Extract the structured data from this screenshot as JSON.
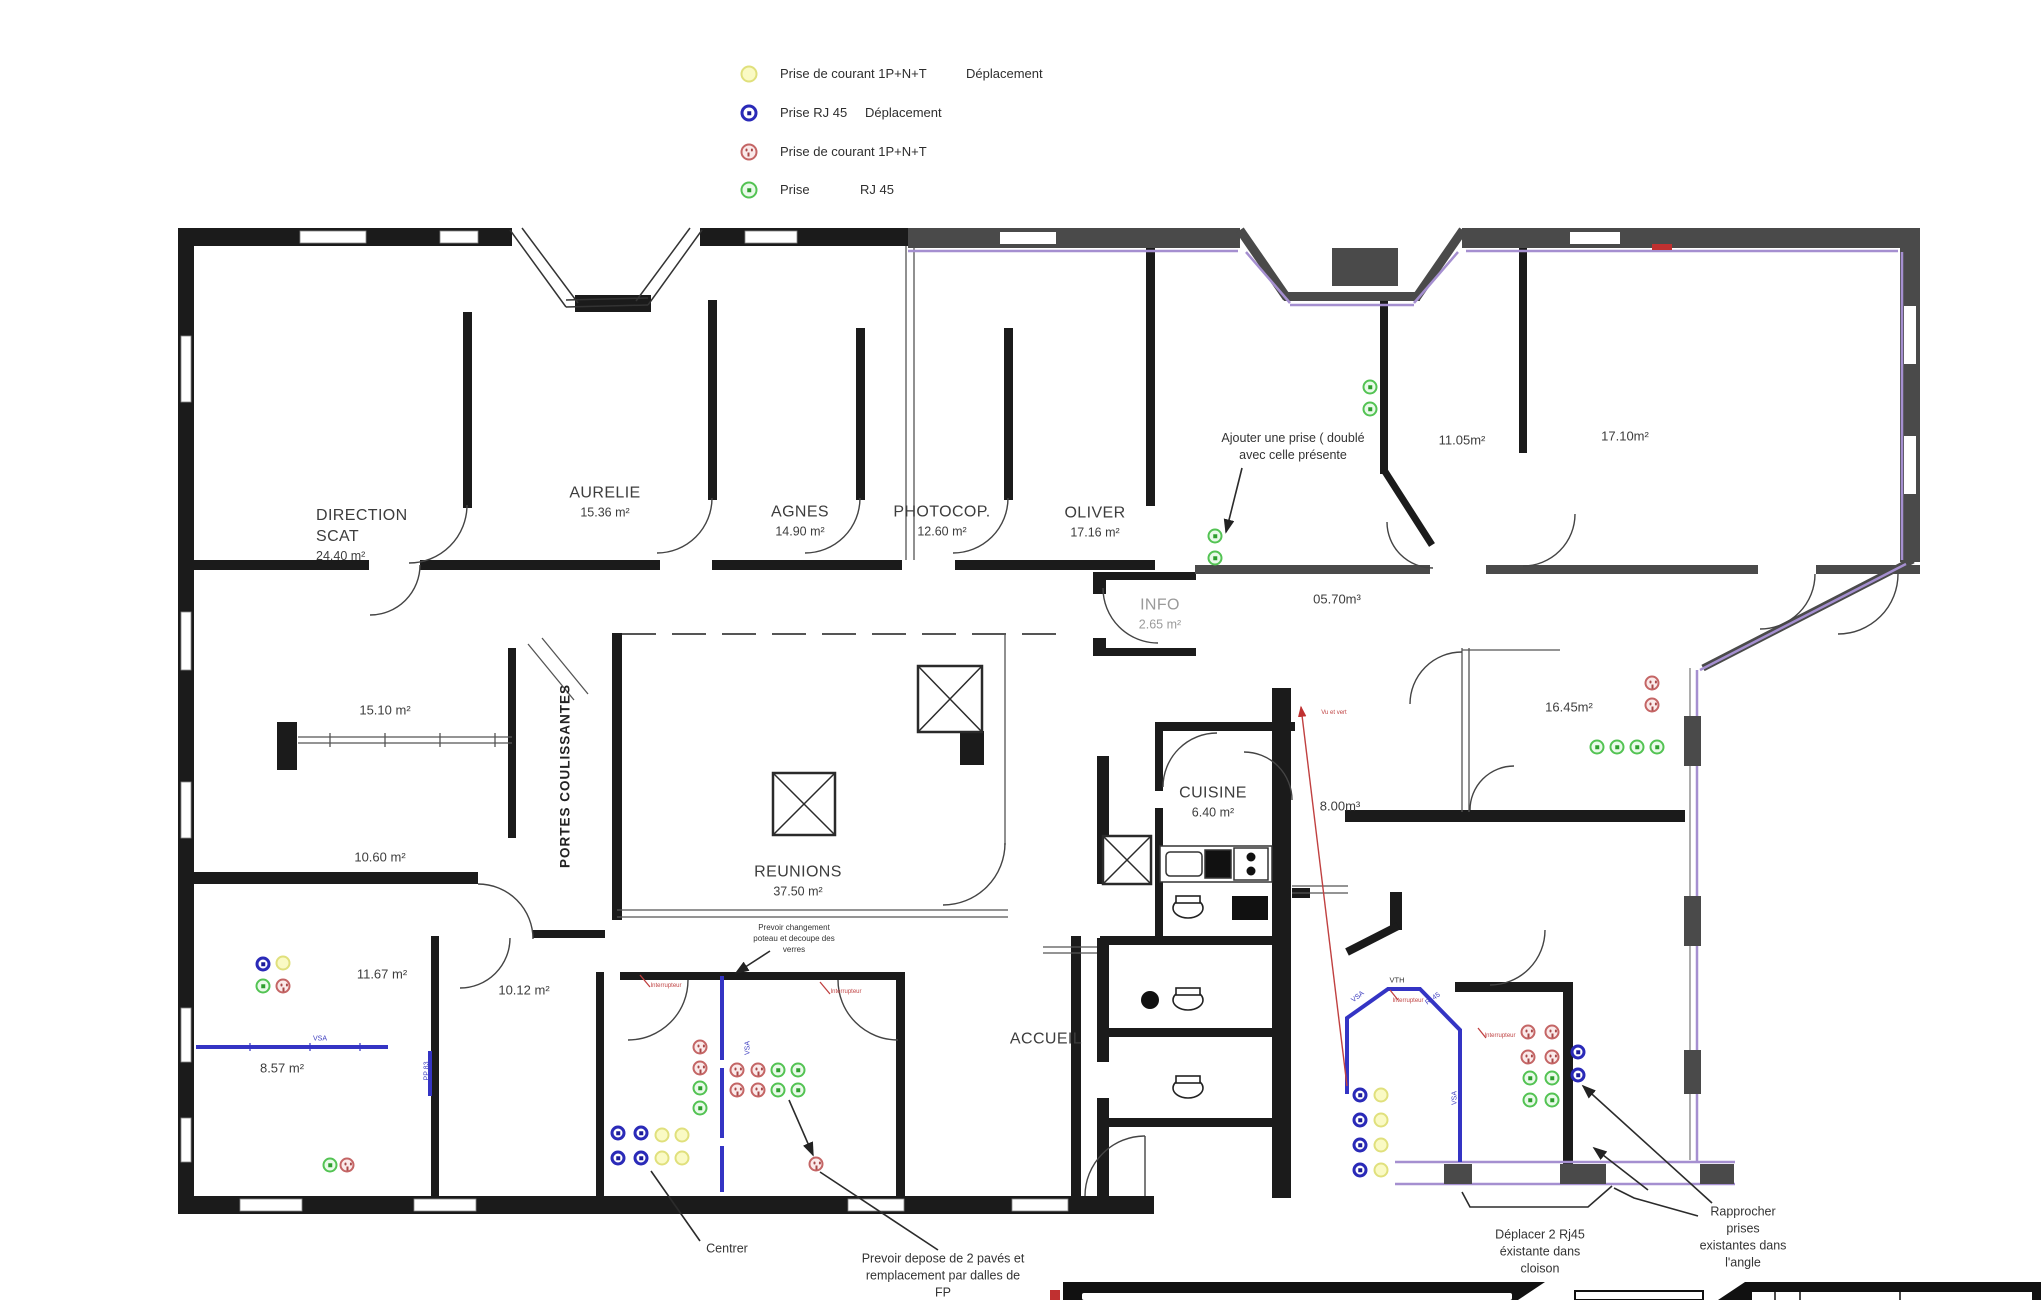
{
  "legend": {
    "rows": [
      {
        "icon": "prise-courant-deplacement",
        "type": "py",
        "label": "Prise de courant 1P+N+T",
        "extra": "Déplacement",
        "icon_x": 749,
        "y": 74,
        "extra_x": 966
      },
      {
        "icon": "prise-rj45-deplacement",
        "type": "rb",
        "label": "Prise RJ 45",
        "extra": "Déplacement",
        "icon_x": 749,
        "y": 113,
        "extra_x": 865
      },
      {
        "icon": "prise-courant",
        "type": "pr",
        "label": "Prise de courant 1P+N+T",
        "extra": "",
        "icon_x": 749,
        "y": 152,
        "extra_x": 0
      },
      {
        "icon": "prise-rj45",
        "type": "rg",
        "label": "Prise",
        "extra": "RJ 45",
        "icon_x": 749,
        "y": 190,
        "extra_x": 860
      }
    ]
  },
  "socket_types": {
    "py": "Prise de courant 1P+N+T Déplacement",
    "rb": "Prise RJ 45 Déplacement",
    "pr": "Prise de courant 1P+N+T",
    "rg": "Prise RJ 45"
  },
  "rooms": [
    {
      "name_lines": [
        "DIRECTION",
        "SCAT"
      ],
      "area": "24.40 m²",
      "x": 316,
      "y": 535,
      "align": "left"
    },
    {
      "name_lines": [
        "AURELIE"
      ],
      "area": "15.36 m²",
      "x": 605,
      "y": 502
    },
    {
      "name_lines": [
        "AGNES"
      ],
      "area": "14.90 m²",
      "x": 800,
      "y": 521
    },
    {
      "name_lines": [
        "PHOTOCOP."
      ],
      "area": "12.60 m²",
      "x": 942,
      "y": 521
    },
    {
      "name_lines": [
        "OLIVER"
      ],
      "area": "17.16 m²",
      "x": 1095,
      "y": 522
    },
    {
      "name_lines": [
        "INFO"
      ],
      "area": "2.65 m²",
      "x": 1160,
      "y": 614,
      "color": "#9a9a9a"
    },
    {
      "name_lines": [
        "REUNIONS"
      ],
      "area": "37.50 m²",
      "x": 798,
      "y": 881
    },
    {
      "name_lines": [
        "CUISINE"
      ],
      "area": "6.40 m²",
      "x": 1213,
      "y": 802
    },
    {
      "name_lines": [
        "ACCUEIL"
      ],
      "area": "",
      "x": 1046,
      "y": 1040
    },
    {
      "name_lines": [],
      "area": "15.10 m²",
      "x": 385,
      "y": 711
    },
    {
      "name_lines": [],
      "area": "10.60 m²",
      "x": 380,
      "y": 858
    },
    {
      "name_lines": [],
      "area": "11.67 m²",
      "x": 382,
      "y": 975
    },
    {
      "name_lines": [],
      "area": "10.12 m²",
      "x": 524,
      "y": 991
    },
    {
      "name_lines": [],
      "area": "8.57 m²",
      "x": 282,
      "y": 1069
    },
    {
      "name_lines": [],
      "area": "05.70m³",
      "x": 1337,
      "y": 600
    },
    {
      "name_lines": [],
      "area": "11.05m²",
      "x": 1462,
      "y": 441
    },
    {
      "name_lines": [],
      "area": "17.10m²",
      "x": 1625,
      "y": 437
    },
    {
      "name_lines": [],
      "area": "16.45m²",
      "x": 1569,
      "y": 708
    },
    {
      "name_lines": [],
      "area": "8.00m³",
      "x": 1340,
      "y": 807
    }
  ],
  "annotations": [
    {
      "id": "ajouter-prise",
      "lines": [
        "Ajouter une prise ( doublé",
        "avec celle présente"
      ],
      "x": 1293,
      "y": 447,
      "size": 12.5
    },
    {
      "id": "prevoir-changement",
      "lines": [
        "Prevoir changement",
        "poteau et decoupe des",
        "verres"
      ],
      "x": 794,
      "y": 939,
      "size": 8
    },
    {
      "id": "centrer",
      "lines": [
        "Centrer"
      ],
      "x": 727,
      "y": 1249,
      "size": 12.5
    },
    {
      "id": "prevoir-depose",
      "lines": [
        "Prevoir depose de 2 pavés et",
        "remplacement par dalles de",
        "FP"
      ],
      "x": 943,
      "y": 1276,
      "size": 12.5
    },
    {
      "id": "deplacer-rj45",
      "lines": [
        "Déplacer 2 Rj45",
        "éxistante dans",
        "cloison"
      ],
      "x": 1540,
      "y": 1252,
      "size": 12.5
    },
    {
      "id": "rapprocher-prises",
      "lines": [
        "Rapprocher",
        "prises",
        "existantes dans",
        "l'angle"
      ],
      "x": 1743,
      "y": 1237,
      "size": 12.5
    }
  ],
  "wall_labels": [
    {
      "text": "PORTES COULISSANTES",
      "x": 565,
      "y": 776,
      "rot": -90,
      "size": 13.5,
      "color": "#222",
      "bold": true,
      "spacing": 1
    },
    {
      "text": "VSA",
      "x": 320,
      "y": 1039,
      "rot": 0,
      "size": 7,
      "color": "#4040c0"
    },
    {
      "text": "VSA",
      "x": 748,
      "y": 1048,
      "rot": -90,
      "size": 7,
      "color": "#4040c0"
    },
    {
      "text": "VSA",
      "x": 1358,
      "y": 997,
      "rot": -38,
      "size": 7,
      "color": "#4040c0"
    },
    {
      "text": "VSA",
      "x": 1455,
      "y": 1098,
      "rot": -90,
      "size": 7,
      "color": "#4040c0"
    },
    {
      "text": "Rj 45",
      "x": 1433,
      "y": 999,
      "rot": -35,
      "size": 7,
      "color": "#4040c0"
    },
    {
      "text": "VTH",
      "x": 1397,
      "y": 980,
      "rot": 0,
      "size": 7.5,
      "color": "#333"
    },
    {
      "text": "PP 83",
      "x": 427,
      "y": 1071,
      "rot": -90,
      "size": 7,
      "color": "#4040c0"
    },
    {
      "text": "Interrupteur",
      "x": 666,
      "y": 986,
      "rot": 0,
      "size": 6,
      "color": "#c04545"
    },
    {
      "text": "Interrupteur",
      "x": 846,
      "y": 992,
      "rot": 0,
      "size": 6,
      "color": "#c04545"
    },
    {
      "text": "Interrupteur",
      "x": 1408,
      "y": 1001,
      "rot": 0,
      "size": 6,
      "color": "#c04545"
    },
    {
      "text": "Interrupteur",
      "x": 1500,
      "y": 1036,
      "rot": 0,
      "size": 6,
      "color": "#c04545"
    },
    {
      "text": "Vu et vert",
      "x": 1334,
      "y": 713,
      "rot": 0,
      "size": 6,
      "color": "#c04545"
    }
  ],
  "sockets": [
    {
      "t": "rg",
      "x": 1370,
      "y": 387
    },
    {
      "t": "rg",
      "x": 1370,
      "y": 409
    },
    {
      "t": "rg",
      "x": 1215,
      "y": 536
    },
    {
      "t": "rg",
      "x": 1215,
      "y": 558
    },
    {
      "t": "rg",
      "x": 1597,
      "y": 747
    },
    {
      "t": "rg",
      "x": 1617,
      "y": 747
    },
    {
      "t": "rg",
      "x": 1637,
      "y": 747
    },
    {
      "t": "rg",
      "x": 1657,
      "y": 747
    },
    {
      "t": "rg",
      "x": 263,
      "y": 986
    },
    {
      "t": "rg",
      "x": 330,
      "y": 1165
    },
    {
      "t": "rg",
      "x": 700,
      "y": 1088
    },
    {
      "t": "rg",
      "x": 700,
      "y": 1108
    },
    {
      "t": "rg",
      "x": 778,
      "y": 1070
    },
    {
      "t": "rg",
      "x": 798,
      "y": 1070
    },
    {
      "t": "rg",
      "x": 778,
      "y": 1090
    },
    {
      "t": "rg",
      "x": 798,
      "y": 1090
    },
    {
      "t": "rg",
      "x": 1530,
      "y": 1078
    },
    {
      "t": "rg",
      "x": 1552,
      "y": 1078
    },
    {
      "t": "rg",
      "x": 1530,
      "y": 1100
    },
    {
      "t": "rg",
      "x": 1552,
      "y": 1100
    },
    {
      "t": "pr",
      "x": 1652,
      "y": 683
    },
    {
      "t": "pr",
      "x": 1652,
      "y": 705
    },
    {
      "t": "pr",
      "x": 283,
      "y": 986
    },
    {
      "t": "pr",
      "x": 347,
      "y": 1165
    },
    {
      "t": "pr",
      "x": 700,
      "y": 1047
    },
    {
      "t": "pr",
      "x": 700,
      "y": 1068
    },
    {
      "t": "pr",
      "x": 737,
      "y": 1070
    },
    {
      "t": "pr",
      "x": 758,
      "y": 1070
    },
    {
      "t": "pr",
      "x": 737,
      "y": 1090
    },
    {
      "t": "pr",
      "x": 758,
      "y": 1090
    },
    {
      "t": "pr",
      "x": 816,
      "y": 1164
    },
    {
      "t": "pr",
      "x": 1528,
      "y": 1032
    },
    {
      "t": "pr",
      "x": 1552,
      "y": 1032
    },
    {
      "t": "pr",
      "x": 1528,
      "y": 1057
    },
    {
      "t": "pr",
      "x": 1552,
      "y": 1057
    },
    {
      "t": "rb",
      "x": 263,
      "y": 964
    },
    {
      "t": "rb",
      "x": 618,
      "y": 1133
    },
    {
      "t": "rb",
      "x": 641,
      "y": 1133
    },
    {
      "t": "rb",
      "x": 618,
      "y": 1158
    },
    {
      "t": "rb",
      "x": 641,
      "y": 1158
    },
    {
      "t": "rb",
      "x": 1360,
      "y": 1095
    },
    {
      "t": "rb",
      "x": 1360,
      "y": 1120
    },
    {
      "t": "rb",
      "x": 1360,
      "y": 1145
    },
    {
      "t": "rb",
      "x": 1360,
      "y": 1170
    },
    {
      "t": "rb",
      "x": 1578,
      "y": 1052
    },
    {
      "t": "rb",
      "x": 1578,
      "y": 1075
    },
    {
      "t": "py",
      "x": 283,
      "y": 963
    },
    {
      "t": "py",
      "x": 662,
      "y": 1135
    },
    {
      "t": "py",
      "x": 682,
      "y": 1135
    },
    {
      "t": "py",
      "x": 662,
      "y": 1158
    },
    {
      "t": "py",
      "x": 682,
      "y": 1158
    },
    {
      "t": "py",
      "x": 1381,
      "y": 1095
    },
    {
      "t": "py",
      "x": 1381,
      "y": 1120
    },
    {
      "t": "py",
      "x": 1381,
      "y": 1145
    },
    {
      "t": "py",
      "x": 1381,
      "y": 1170
    }
  ],
  "colors": {
    "wall_black": "#1b1b1b",
    "wall_gray": "#4a4a4a",
    "wall_purple": "#a58fd0",
    "wall_blue": "#3434c4",
    "socket_yellow": "#fafac4",
    "rj45_blue": "#2a2ab8",
    "socket_red": "#c46565",
    "rj45_green": "#53c353",
    "red_mark": "#c03030"
  }
}
